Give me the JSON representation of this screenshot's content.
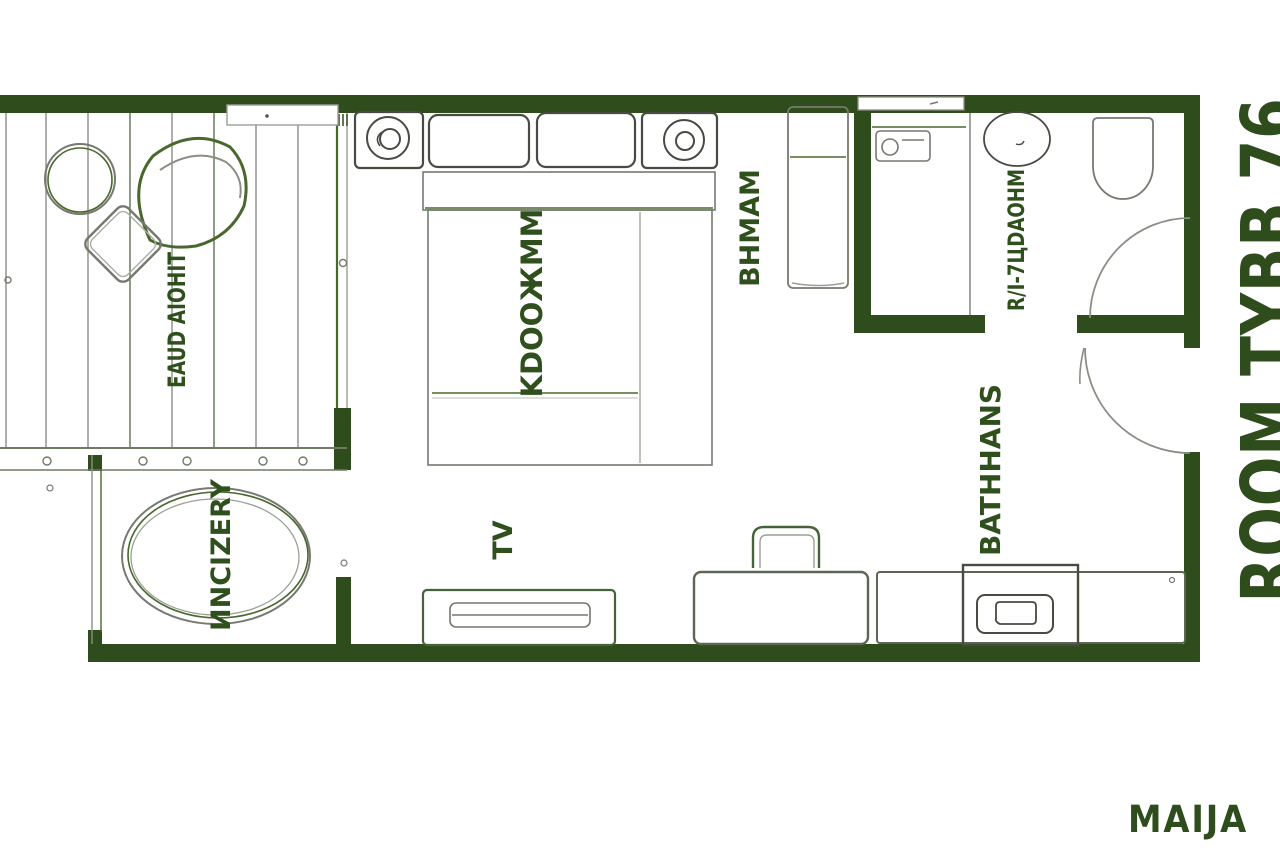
{
  "plan": {
    "room_type_label": "ROOM TYBB 76",
    "brand_label": "MAIJA",
    "labels": {
      "balcony": "EAUD AIOHIT",
      "bed": "KDOOЖMM",
      "wardrobe": "BHMAM",
      "jacuzzi": "ИNCIZERY",
      "tv": "TV",
      "hall": "BATHHANS",
      "bathroom": "R/I-7ЦDAOHM"
    }
  },
  "colors": {
    "wall": "#2e4c1c",
    "label_text": "#2f4f1d",
    "sketch_gray": "#76796f",
    "sketch_green": "#4a682e",
    "background": "#ffffff"
  }
}
